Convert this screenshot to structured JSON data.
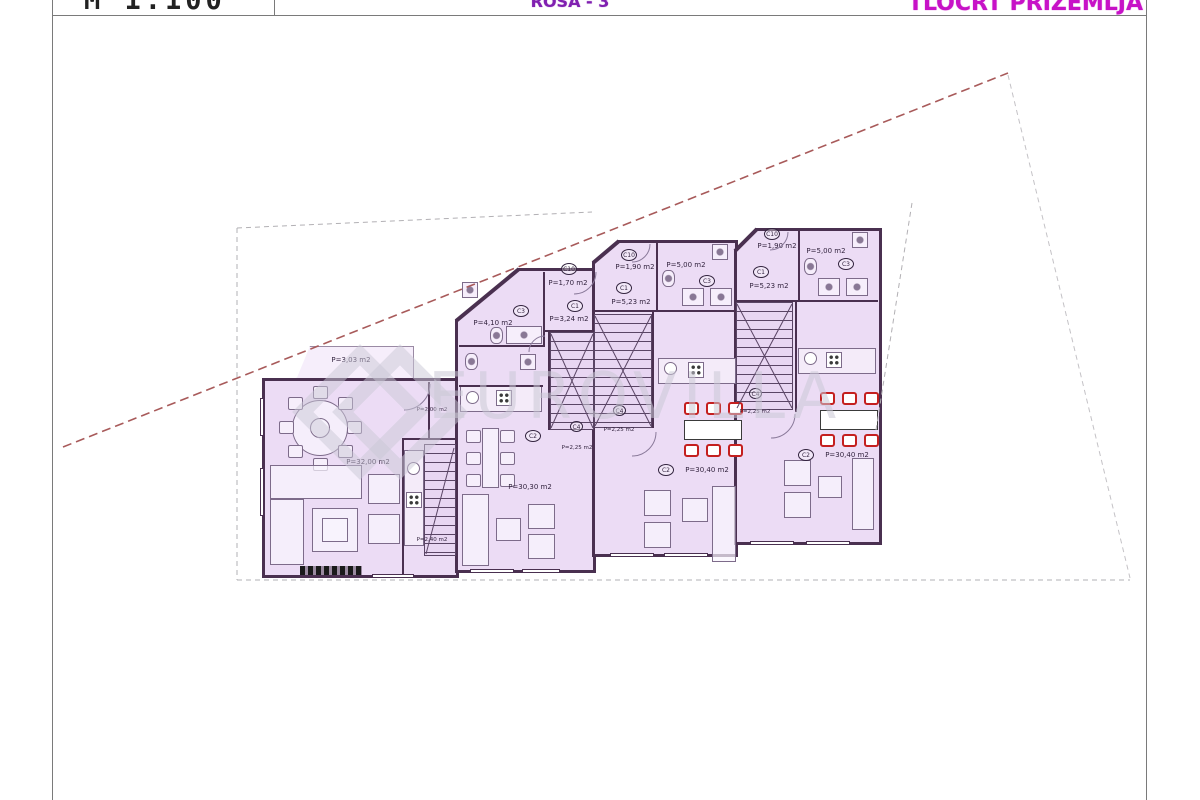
{
  "header": {
    "scale_label": "M 1:100",
    "project_label": "ROSA - 3",
    "title": "TLOCRT PRIZEMLJA"
  },
  "watermark": {
    "text": "EUROVILLA"
  },
  "colors": {
    "wall": "#4a3050",
    "room_fill": "#ecdcf5",
    "furniture_red": "#c41f1f",
    "title_magenta": "#c712c7",
    "project_purple": "#8020b0",
    "parcel_dash_red": "#a85a5a",
    "parcel_dash_gray": "#b2b0b4"
  },
  "plan": {
    "unit1": {
      "terrace_area": "P=3,03 m2",
      "living_area": "P=32,00 m2",
      "pantry_area": "P=2,00 m2",
      "stair_area": "P=2,40 m2"
    },
    "unit2": {
      "c10_code": "C10",
      "c10_area": "P=1,70 m2",
      "c3_code": "C3",
      "c3_area": "P=4,10 m2",
      "c1_code": "C1",
      "c1_area": "P=3,24 m2",
      "c2_code": "C2",
      "c2_area": "P=30,30 m2",
      "c4_code": "C4",
      "c4_area": "P=2,25 m2"
    },
    "unit3": {
      "c10_code": "C10",
      "c10_area": "P=1,90 m2",
      "c3_code": "C3",
      "c3_area": "P=5,00 m2",
      "c1_code": "C1",
      "c1_area": "P=5,23 m2",
      "c2_code": "C2",
      "c2_area": "P=30,40 m2",
      "c4_code": "C4",
      "c4_area": "P=2,25 m2"
    },
    "unit4": {
      "c10_code": "C10",
      "c10_area": "P=1,90 m2",
      "c3_code": "C3",
      "c3_area": "P=5,00 m2",
      "c1_code": "C1",
      "c1_area": "P=5,23 m2",
      "c2_code": "C2",
      "c2_area": "P=30,40 m2",
      "c4_code": "C4",
      "c4_area": "P=2,25 m2"
    }
  }
}
